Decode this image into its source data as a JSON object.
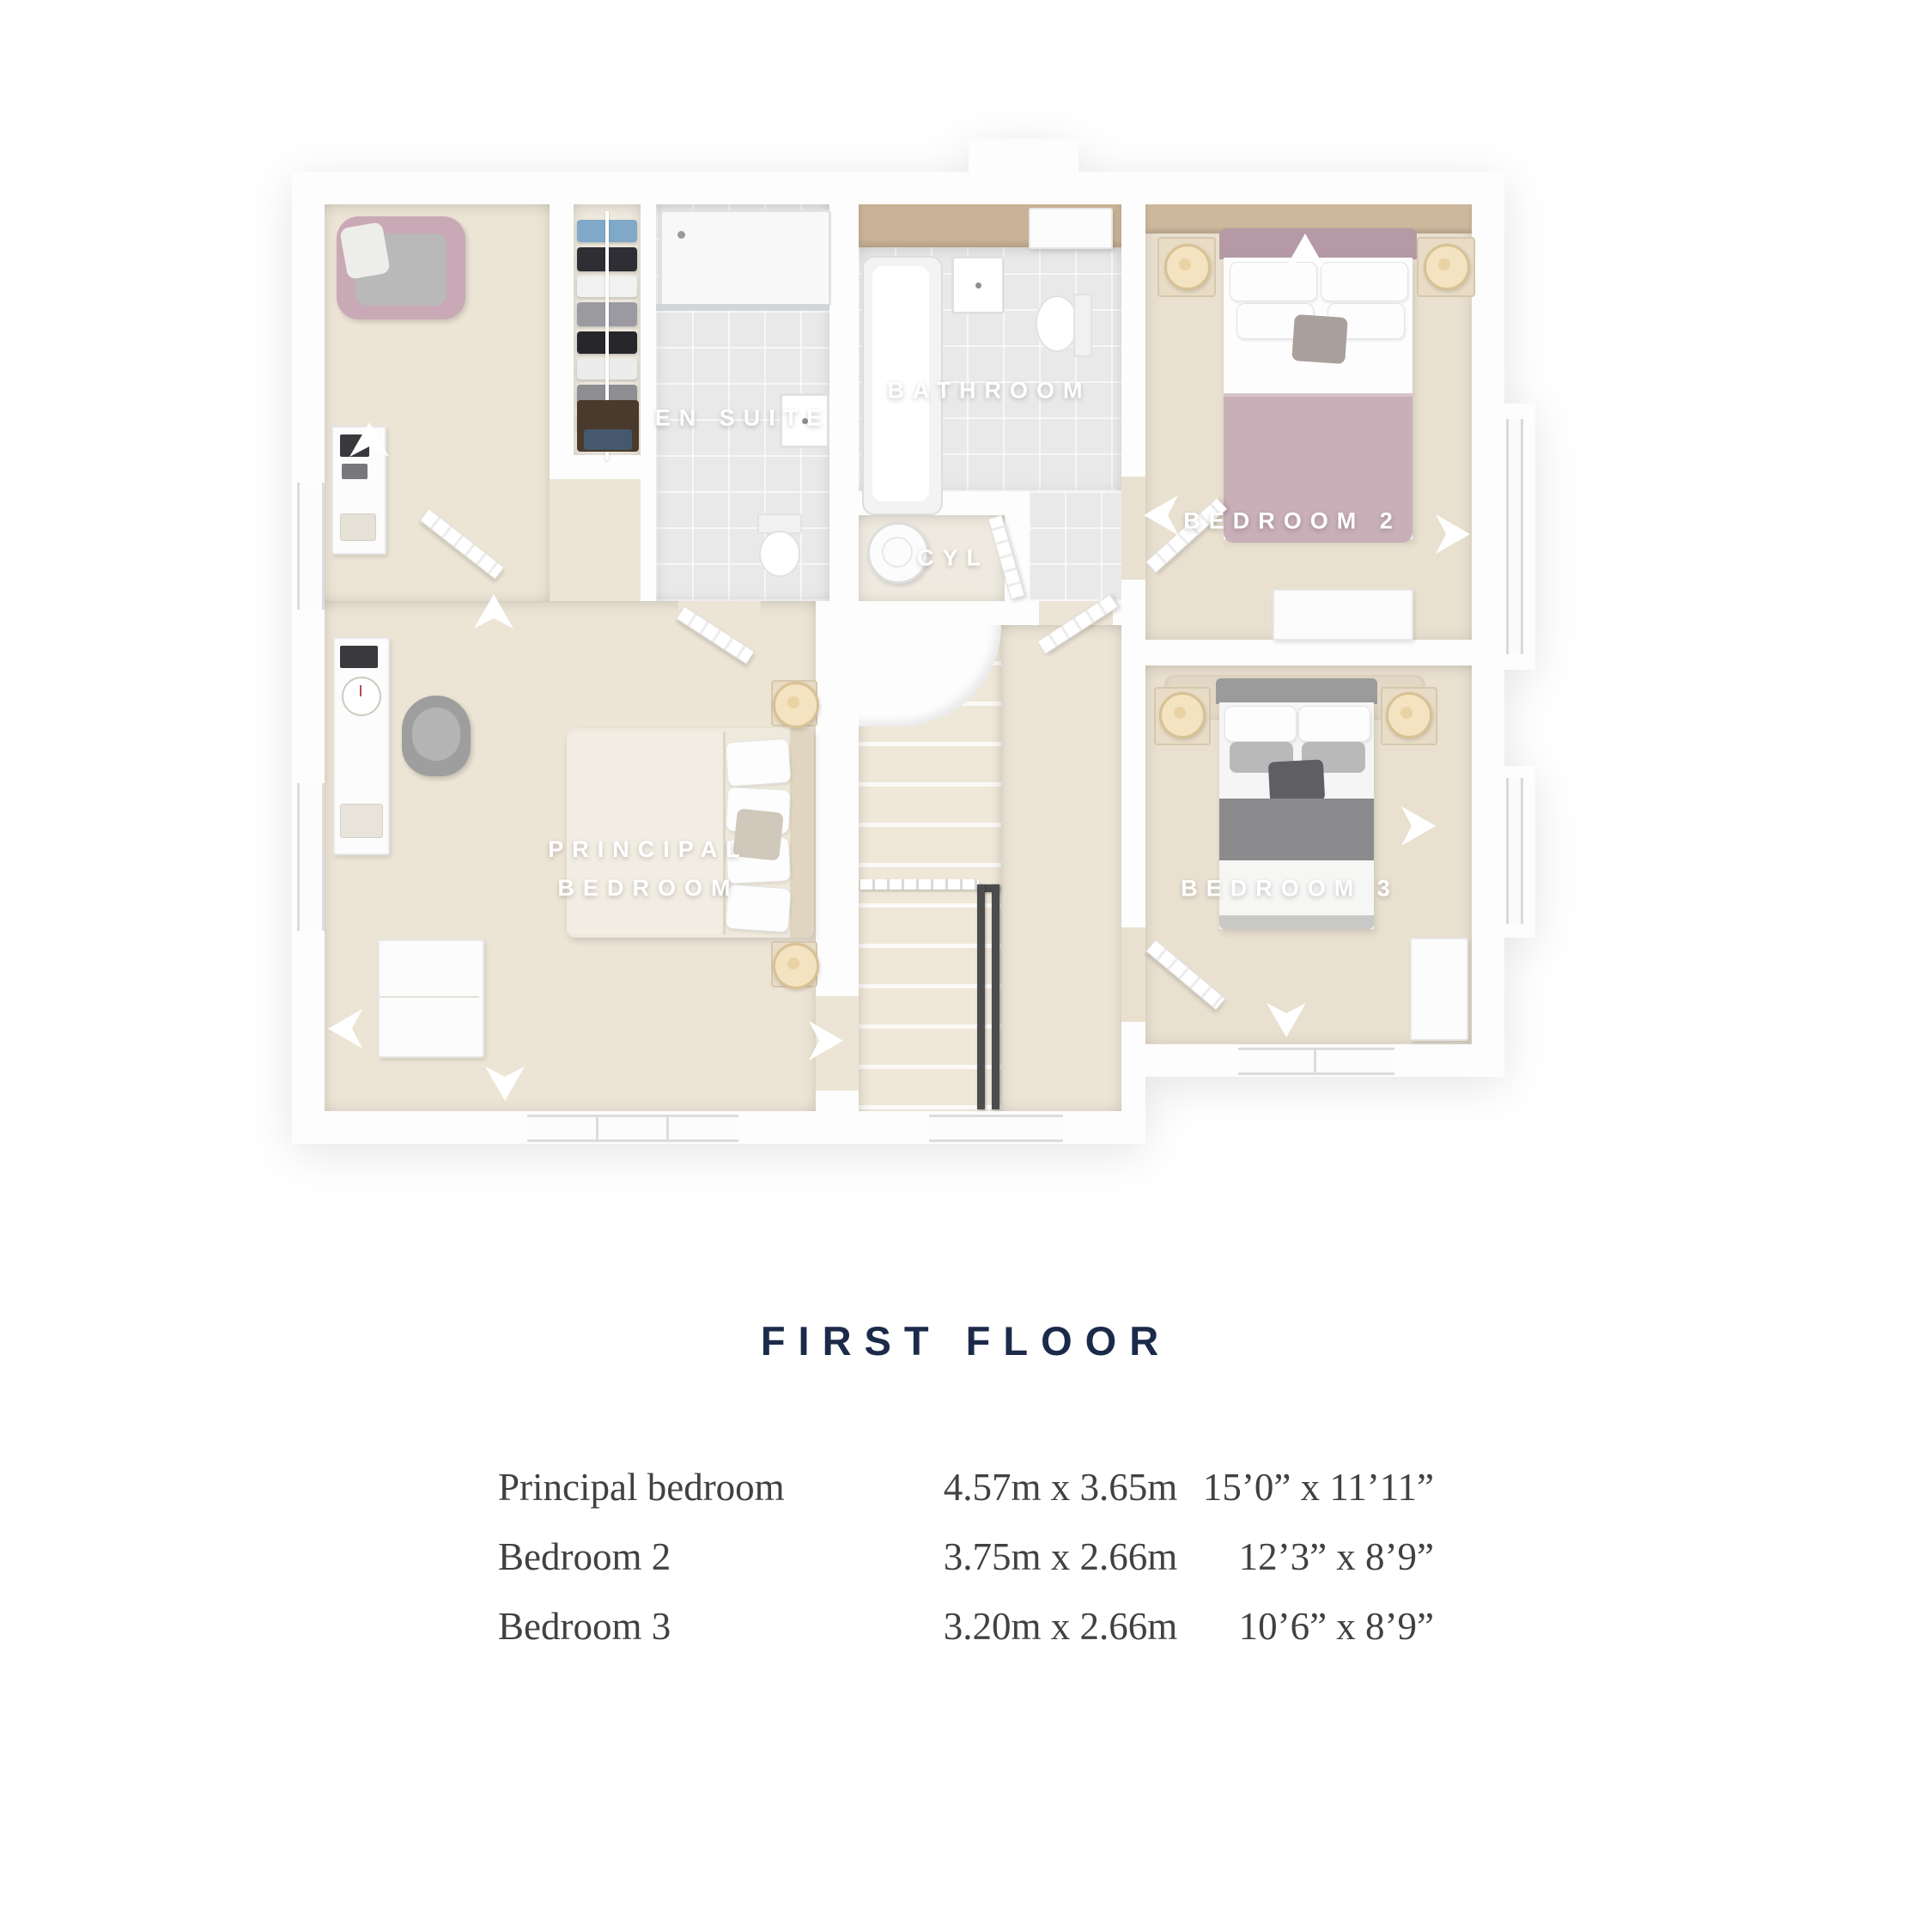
{
  "title": "FIRST FLOOR",
  "rooms": {
    "principal": {
      "label": "PRINCIPAL BEDROOM"
    },
    "bedroom2": {
      "label": "BEDROOM 2"
    },
    "bedroom3": {
      "label": "BEDROOM 3"
    },
    "bathroom": {
      "label": "BATHROOM"
    },
    "ensuite": {
      "label": "EN SUITE"
    },
    "cylinder": {
      "label": "CYL"
    }
  },
  "dims": {
    "rows": [
      {
        "room": "Principal bedroom",
        "metric": "4.57m x 3.65m",
        "imperial": "15’0” x 11’11”"
      },
      {
        "room": "Bedroom 2",
        "metric": "3.75m x 2.66m",
        "imperial": "12’3” x 8’9”"
      },
      {
        "room": "Bedroom 3",
        "metric": "3.20m x 2.66m",
        "imperial": "10’6” x 8’9”"
      }
    ]
  },
  "colors": {
    "accent_navy": "#1c2a4a",
    "table_text": "#414141",
    "carpet": "#ece4d5",
    "carpet_warm": "#e9e0d0",
    "tile": "#e9e9e9",
    "wood": "#c9b296",
    "mauve_bed": "#c9afb8",
    "gray_bed": "#8b8b8d",
    "lamp_cream": "#f3e3c0"
  }
}
